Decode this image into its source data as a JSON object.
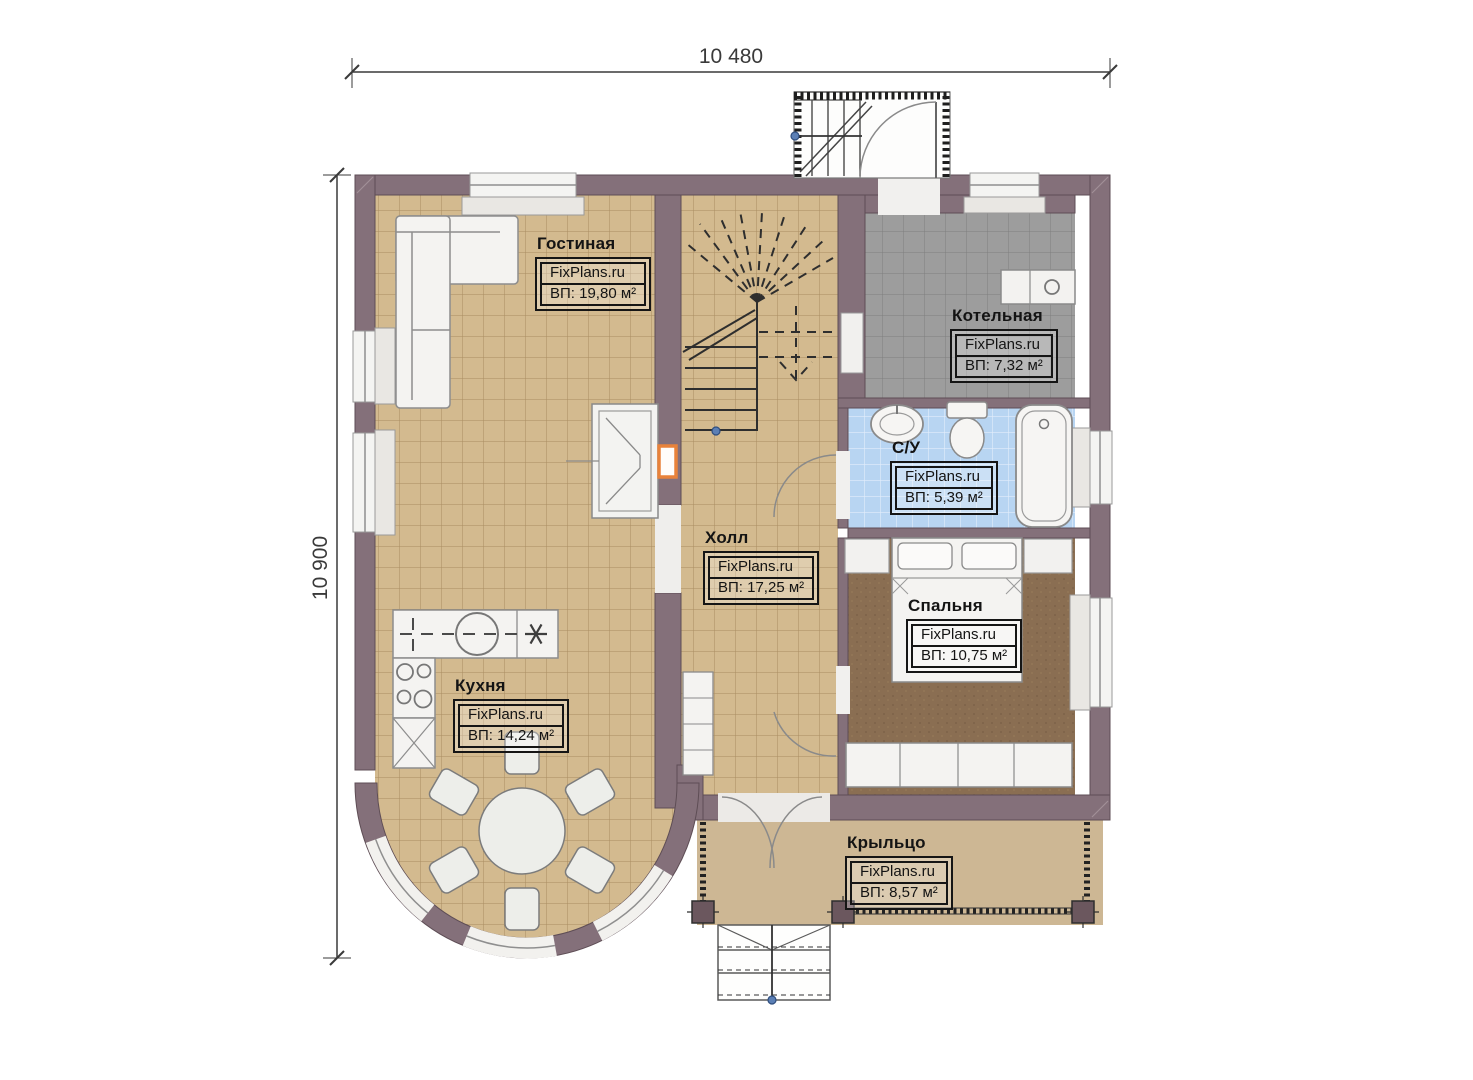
{
  "plan": {
    "dimensions": {
      "width_label": "10 480",
      "height_label": "10 900"
    },
    "watermark": "FixPlans.ru",
    "rooms": [
      {
        "name": "Гостиная",
        "area": "ВП: 19,80 м²"
      },
      {
        "name": "Котельная",
        "area": "ВП: 7,32 м²"
      },
      {
        "name": "С/У",
        "area": "ВП: 5,39 м²"
      },
      {
        "name": "Холл",
        "area": "ВП: 17,25 м²"
      },
      {
        "name": "Спальня",
        "area": "ВП: 10,75 м²"
      },
      {
        "name": "Кухня",
        "area": "ВП: 14,24 м²"
      },
      {
        "name": "Крыльцо",
        "area": "ВП: 8,57 м²"
      }
    ],
    "colors": {
      "wall": "#84707a",
      "floor_tan": "#d3ba8f",
      "floor_gray": "#9d9d9d",
      "floor_blue": "#b8d5f2",
      "floor_bedroom": "#8a6e52",
      "floor_porch": "#cdb794",
      "fixture_white": "#f4f3f1",
      "accent_orange": "#e8823a",
      "marker_blue": "#5b7fb5",
      "dimension_text": "#3a3a3a"
    }
  }
}
